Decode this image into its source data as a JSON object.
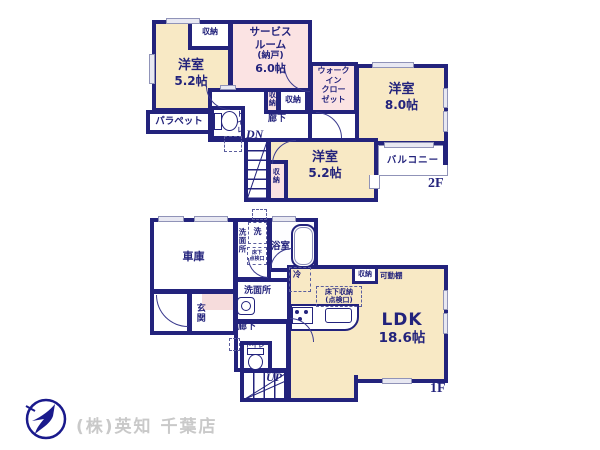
{
  "colors": {
    "wall": "#23237c",
    "room_cream": "#f8e9c5",
    "room_pink": "#fbe3e3",
    "logo_navy": "#1a1a8c",
    "footer_text": "#c9c9c9"
  },
  "floor2": {
    "floor_label": "2F",
    "bedroom_small1": {
      "name": "洋室",
      "size": "5.2帖"
    },
    "bedroom_small2": {
      "name": "洋室",
      "size": "5.2帖"
    },
    "bedroom_large": {
      "name": "洋室",
      "size": "8.0帖"
    },
    "service_room": {
      "l1": "サービス",
      "l2": "ルーム",
      "l3": "(納戸)",
      "size": "6.0帖"
    },
    "wic": {
      "l1": "ウォーク",
      "l2": "イン",
      "l3": "クロー",
      "l4": "ゼット"
    },
    "balcony": "バルコニー",
    "parapet": "パラペット",
    "toilet": "トイレ",
    "hallway": "廊下",
    "stairs_label": "DN",
    "storage": "収納"
  },
  "floor1": {
    "floor_label": "1F",
    "garage": "車庫",
    "washroom_upper": "洗面所",
    "washroom_lower": "洗面所",
    "washer": "洗",
    "underfloor_hatch": {
      "l1": "床下",
      "l2": "点検口"
    },
    "bath": "浴室",
    "fridge": "冷",
    "underfloor_storage": {
      "l1": "床下収納",
      "l2": "(点検口)"
    },
    "storage": "収納",
    "movable_shelf": "可動棚",
    "ldk": {
      "name": "LDK",
      "size": "18.6帖"
    },
    "entrance": "玄関",
    "hallway": "廊下",
    "toilet": "トイレ",
    "stairs_label": "UP"
  },
  "footer": {
    "company": "(株)英知 千葉店"
  }
}
